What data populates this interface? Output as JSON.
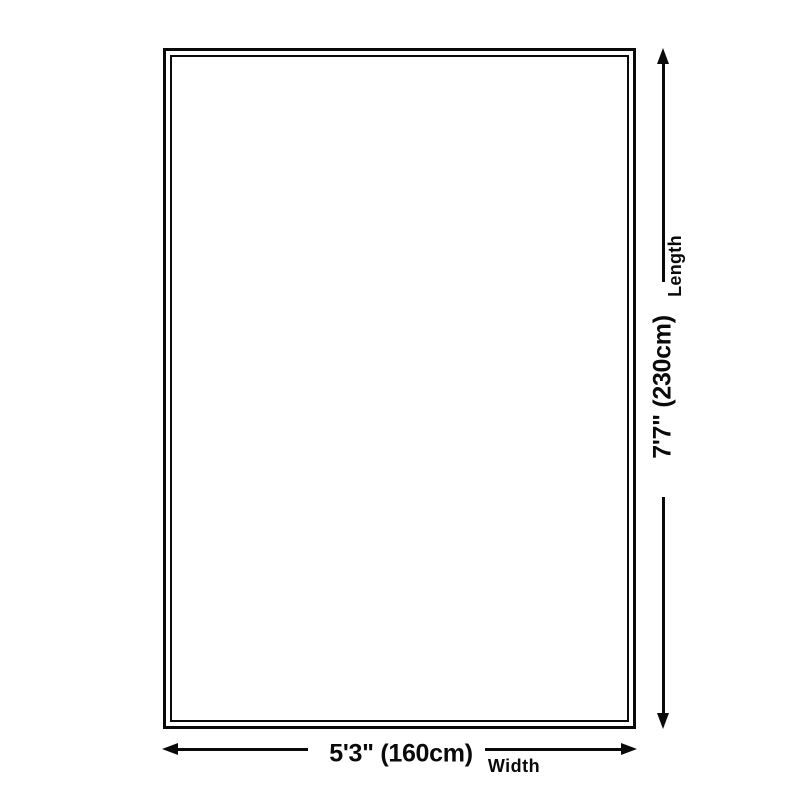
{
  "theme": {
    "ink": "#0a0a0a",
    "background": "#ffffff"
  },
  "diagram": {
    "length": {
      "label": "Length",
      "value": "7'7\" (230cm)"
    },
    "width": {
      "label": "Width",
      "value": "5'3\" (160cm)"
    }
  }
}
